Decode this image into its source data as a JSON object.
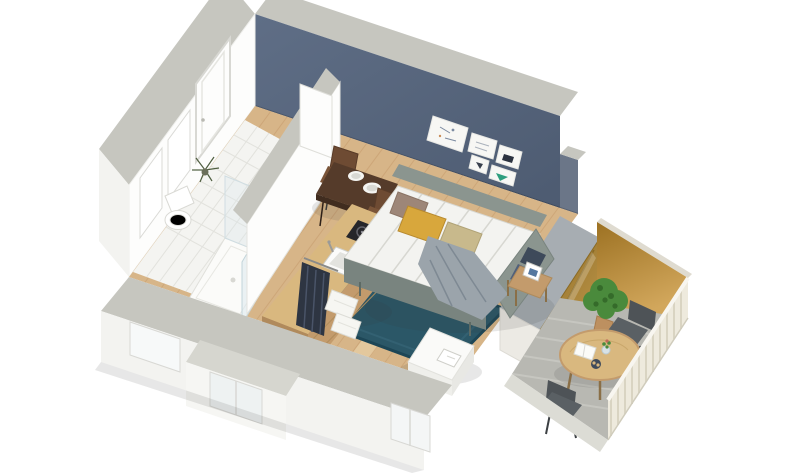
{
  "scene": {
    "type": "isometric-3d-floor-plan-render",
    "subject": "Studio apartment cutaway 3D floor plan",
    "rooms": [
      {
        "id": "entry-hall",
        "features": [
          "entry-door",
          "white-walls",
          "wood-parquet-floor"
        ]
      },
      {
        "id": "bathroom",
        "features": [
          "toilet",
          "walk-in-shower",
          "glass-partition",
          "dry-plant",
          "vanity-basin",
          "white-tile-floor"
        ]
      },
      {
        "id": "kitchenette",
        "features": [
          "two-burner-cooktop",
          "inset-sink",
          "wood-counter",
          "open-wardrobe",
          "hanging-clothes",
          "linen-shelves",
          "drawers"
        ]
      },
      {
        "id": "living-sleeping-area",
        "features": [
          "navy-accent-wall",
          "gallery-of-5-frames",
          "dining-table-for-two",
          "two-brown-chairs",
          "sofa-bed",
          "mustard-pillow",
          "mauve-pillow",
          "khaki-pillow",
          "gray-throw-blanket",
          "teal-area-rug",
          "wood-side-table",
          "photo-frame",
          "white-desk",
          "blue-desk-chair"
        ]
      },
      {
        "id": "terrace",
        "features": [
          "ochre-feature-wall",
          "sliding-glass-door",
          "round-wood-table",
          "two-metal-chairs",
          "potted-plant",
          "white-slat-railing",
          "concrete-floor"
        ]
      }
    ],
    "artwork_frames": 5,
    "dining_place_settings": 2
  },
  "palette": {
    "bg": "#ffffff",
    "wall_cap": "#c6c6bf",
    "wall_cap_light": "#d6d6cf",
    "wall_white": "#fdfdfc",
    "wall_shade": "#efefec",
    "outer_face": "#f3f3f0",
    "blue_top": "#5f6e86",
    "blue_bottom": "#4d5b71",
    "blue_low": "#6b7688",
    "wood_mid": "#d7b588",
    "wood_light": "#ecd7ae",
    "plank_line": "#c19465",
    "tile": "#f4f4f1",
    "tile_line": "#e2e2dd",
    "rug": "#2b5767",
    "rug_dark": "#1d4656",
    "sofa_frame": "#8b958f",
    "sofa_front": "#79847f",
    "mattress": "#f3f3f0",
    "mattress_line": "#d7d7d1",
    "pillow_mauve": "#9d8678",
    "pillow_mustard": "#d8a73c",
    "pillow_khaki": "#c8b98c",
    "blanket": "#9ba4ab",
    "blanket_dark": "#7e8993",
    "navy_stripe": "#3e4a5a",
    "navy_stripe2": "#51607a",
    "table_brown": "#553b2a",
    "table_brown_dark": "#402c1f",
    "chair_brown": "#6e4b33",
    "chair_seat": "#7a5438",
    "counter_wood": "#d9b87f",
    "wood_dark": "#c39b6c",
    "clothes_dark": "#2e3542",
    "clothes_streak": "#4a5468",
    "linen_white": "#f6f6f2",
    "cooktop": "#26262a",
    "desk_white": "#fafaf8",
    "chair_blue": "#4f81a4",
    "chair_blue_dark": "#3b6a8c",
    "terrace_floor": "#b8b8b2",
    "terrace_stripe": "#c9c9c3",
    "ochre_dark": "#9c7122",
    "ochre_light": "#d2a75c",
    "railing": "#eeeadd",
    "railing_line": "#d9d4c2",
    "gold_door": "#a8832f",
    "gold_door_dark": "#8a6a24",
    "gold_door_light": "#c49b4e",
    "plant_green": "#4a8a3c",
    "plant_dark": "#356b2a",
    "pot_tan": "#bd9060",
    "glass": "#d9e8ee",
    "metal_gray": "#4e5357",
    "metal_seat": "#5a6064",
    "sep_top": "#a7adb2",
    "shadow": "rgba(60,60,55,0.12)"
  }
}
